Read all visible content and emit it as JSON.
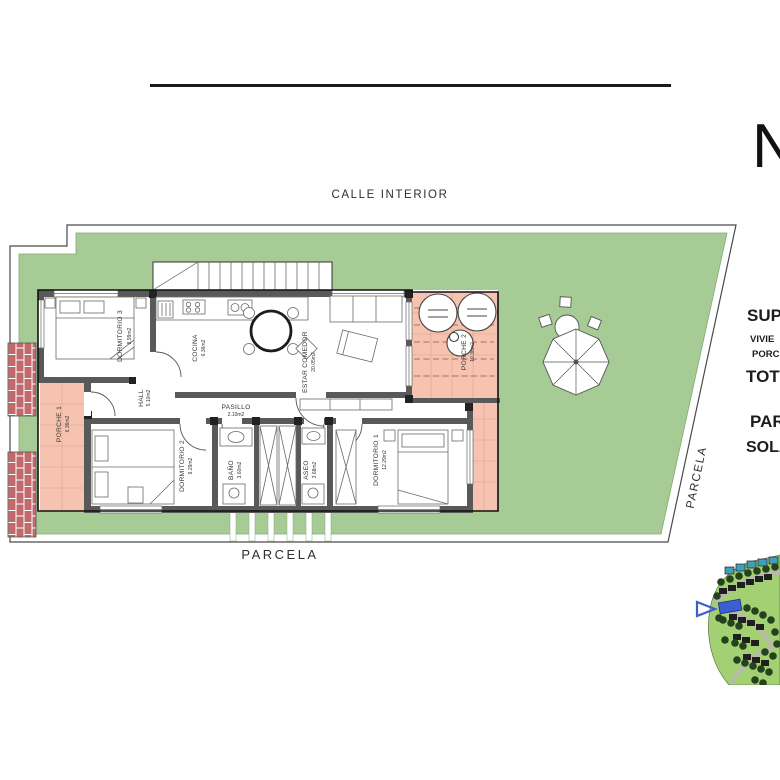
{
  "page": {
    "north_label": "N",
    "street_label": "CALLE INTERIOR",
    "parcel_label_bottom": "PARCELA",
    "parcel_label_side": "PARCELA"
  },
  "rooms": {
    "dormitorio3": {
      "name": "DORMITORIO 3",
      "area": "8.99m2"
    },
    "cocina": {
      "name": "COCINA",
      "area": "6.36m2"
    },
    "estar": {
      "name": "ESTAR COMEDOR",
      "area": "20.05m2"
    },
    "porche2": {
      "name": "PORCHE 2",
      "area": "10.36m2"
    },
    "hall": {
      "name": "HALL",
      "area": "5.10m2"
    },
    "pasillo": {
      "name": "PASILLO",
      "area": "2.10m2"
    },
    "porche1": {
      "name": "PORCHE 1",
      "area": "6.36m2"
    },
    "dormitorio2": {
      "name": "DORMITORIO 2",
      "area": "9.29m2"
    },
    "bano": {
      "name": "BAÑO",
      "area": "3.60m2"
    },
    "aseo": {
      "name": "ASEO",
      "area": "3.68m2"
    },
    "dormitorio1": {
      "name": "DORMITORIO 1",
      "area": "12.29m2"
    }
  },
  "summary_fragments": {
    "superficies": "SUP",
    "vivienda": "VIVIE",
    "porches": "PORC",
    "total": "TOT",
    "parcela": "PAR",
    "solarium": "SOLA"
  },
  "colors": {
    "garden_green": "#a6cb95",
    "porch_salmon": "#f6c3b0",
    "brick_red": "#c2696c",
    "wall_gray": "#595959",
    "sitemap_green": "#a2d072",
    "sitemap_tree_green": "#24421d",
    "highlight_blue": "#3b5fd1"
  }
}
